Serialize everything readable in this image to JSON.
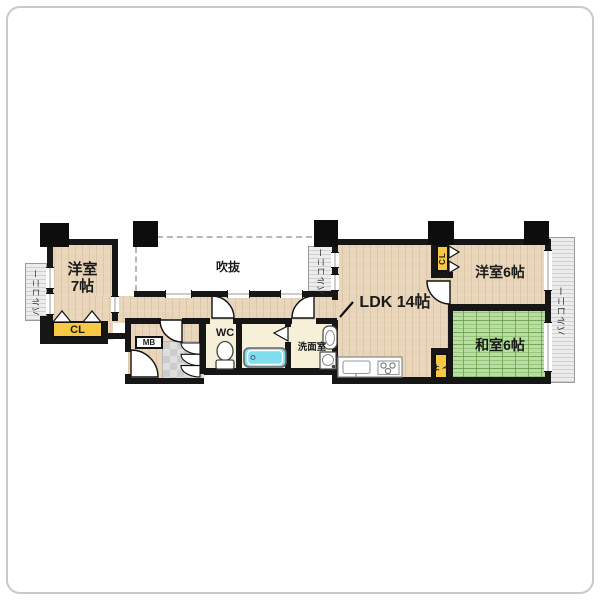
{
  "plan_type": "apartment-floor-plan",
  "rooms": {
    "western7": {
      "name": "洋室",
      "size": "7帖"
    },
    "void": {
      "label": "吹抜"
    },
    "ldk": {
      "label": "LDK 14帖"
    },
    "western6": {
      "label": "洋室6帖"
    },
    "japanese6": {
      "label": "和室6帖"
    },
    "washroom": {
      "label": "洗面室"
    },
    "wc": {
      "label": "WC"
    }
  },
  "storage": {
    "closet_left": "CL",
    "closet_right": "CL",
    "oshiire": "押入"
  },
  "utility": {
    "meter_box": "MB"
  },
  "balconies": {
    "left": "バルコニー",
    "middle": "バルコニー",
    "right": "バルコニー"
  },
  "colors": {
    "wall": "#161616",
    "wood_floor": "#e9d6ba",
    "tatami_green": "#b9dda2",
    "closet_yellow": "#f6c844",
    "bathtub_cyan": "#7fdfee",
    "balcony_gray": "#ececec",
    "service_cream": "#f6f0d9",
    "tile_gray": "#d9d9d9"
  }
}
